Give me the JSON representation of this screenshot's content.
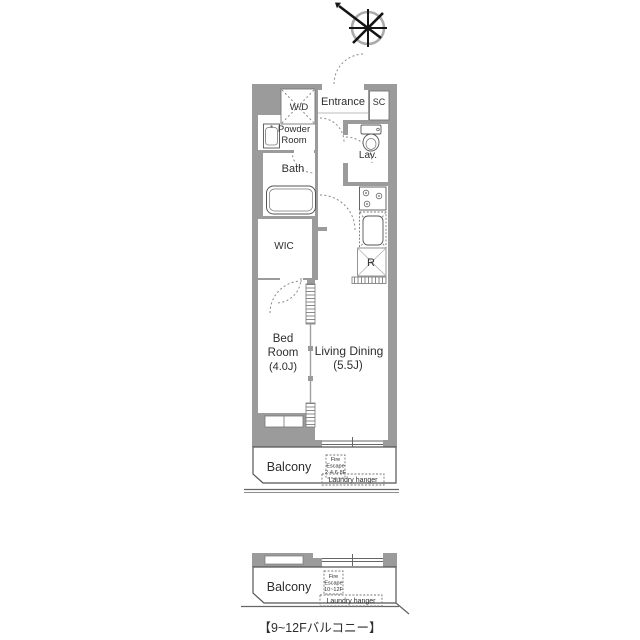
{
  "colors": {
    "wall_gray": "#9b9b9b",
    "fixture_line": "#555555",
    "dashed_line": "#888888",
    "text": "#2e2e2e",
    "background": "#ffffff"
  },
  "compass": {
    "icon": "compass-north-arrow"
  },
  "floor_plan": {
    "rooms": {
      "entrance": {
        "label": "Entrance"
      },
      "shoe_closet": {
        "label": "SC"
      },
      "washer_dryer": {
        "label": "W/D"
      },
      "powder_room": {
        "label_line1": "Powder",
        "label_line2": "Room"
      },
      "lavatory": {
        "label": "Lav."
      },
      "bath": {
        "label": "Bath"
      },
      "wic": {
        "label": "WIC"
      },
      "bedroom": {
        "label_line1": "Bed",
        "label_line2": "Room",
        "size": "(4.0J)"
      },
      "living_dining": {
        "label": "Living Dining",
        "size": "(5.5J)"
      },
      "refrigerator_space": {
        "label": "R"
      }
    },
    "balcony": {
      "label": "Balcony",
      "fire_escape": {
        "line1": "Fire",
        "line2": "Escape",
        "line3": "2·4·6·8F"
      },
      "laundry_hanger": "Laundry hanger"
    }
  },
  "balcony_detail": {
    "label": "Balcony",
    "fire_escape": {
      "line1": "Fire",
      "line2": "Escape",
      "line3": "10~12F"
    },
    "laundry_hanger": "Laundry hanger",
    "caption": "【9~12Fバルコニー】"
  }
}
